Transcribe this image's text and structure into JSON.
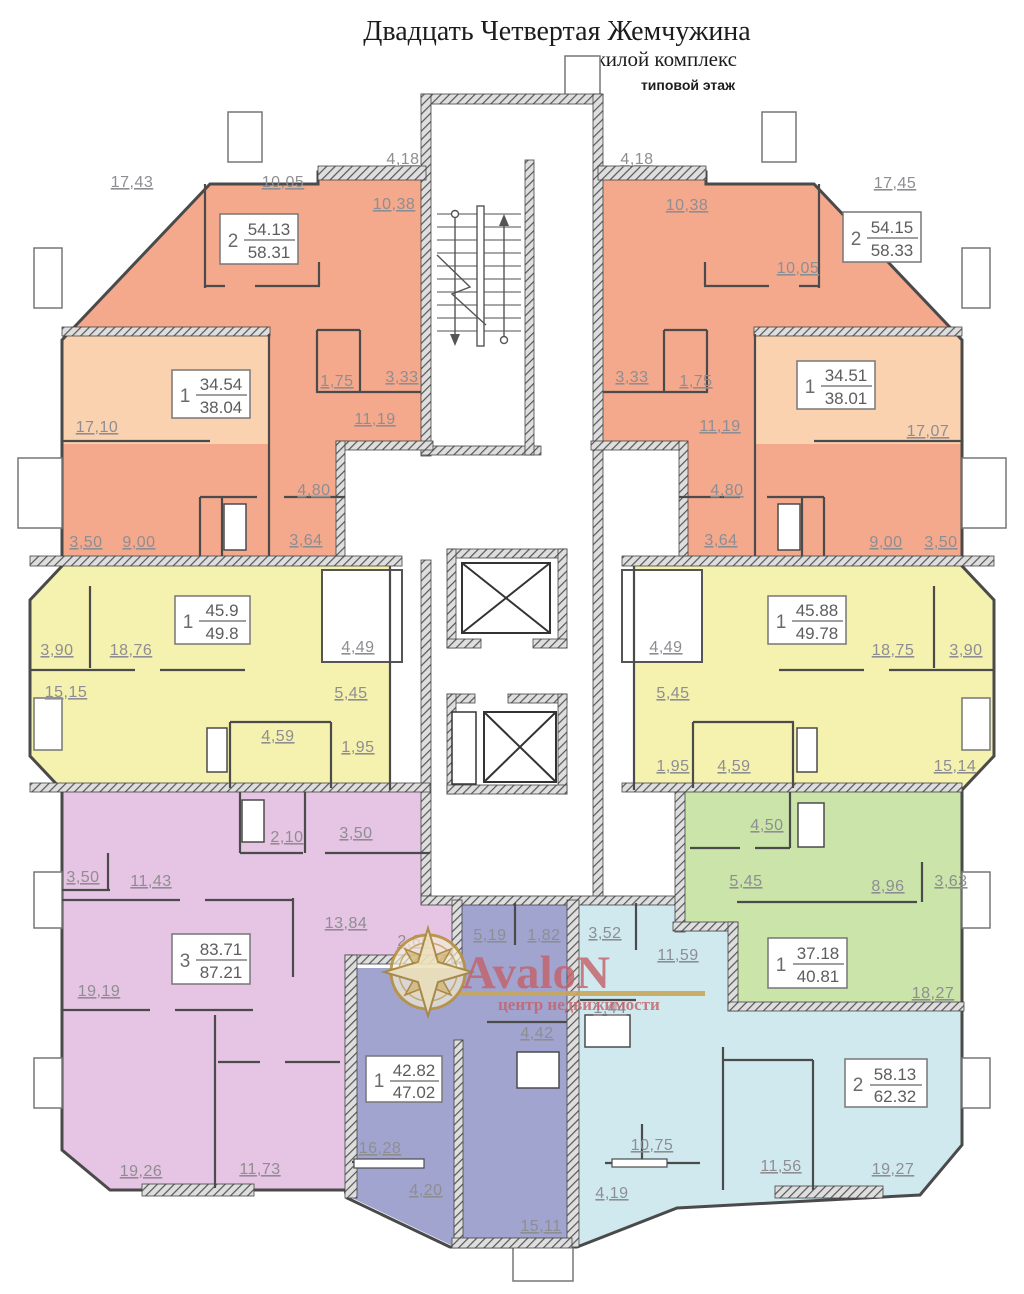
{
  "header": {
    "title": "Двадцать Четвертая  Жемчужина",
    "subtitle": "жилой комплекс",
    "floor_label": "типовой этаж"
  },
  "logo": {
    "brand": "AvaloN",
    "tagline": "центр недвижимости",
    "star_color": "#b8923f",
    "text_color": "#c4636c"
  },
  "palette": {
    "salmon": "#f4a88c",
    "peach": "#fad2b0",
    "yellow": "#f5f1ae",
    "purple": "#e6c4e3",
    "indigo": "#a0a4cf",
    "cyan": "#cfe9ef",
    "green": "#cae4a9",
    "wall": "#4a4a4a",
    "dim_text": "#8e8e92"
  },
  "apartments": {
    "tl2": {
      "type": "2",
      "living": "54.13",
      "total": "58.31",
      "rooms": {
        "r1": "17,43",
        "r2": "10,05",
        "r3": "4,18",
        "r4": "10,38",
        "r5": "1,75",
        "r6": "3,33",
        "r7": "11,19"
      }
    },
    "tr2": {
      "type": "2",
      "living": "54.15",
      "total": "58.33",
      "rooms": {
        "r1": "4,18",
        "r2": "10,38",
        "r3": "17,45",
        "r4": "10,05",
        "r5": "3,33",
        "r6": "1,75",
        "r7": "11,19"
      }
    },
    "tl1": {
      "type": "1",
      "living": "34.54",
      "total": "38.04",
      "rooms": {
        "r1": "17,10",
        "r2": "3,50",
        "r3": "9,00",
        "r4": "4,80",
        "r5": "3,64"
      }
    },
    "tr1": {
      "type": "1",
      "living": "34.51",
      "total": "38.01",
      "rooms": {
        "r1": "17,07",
        "r2": "4,80",
        "r3": "3,64",
        "r4": "9,00",
        "r5": "3,50"
      }
    },
    "yl": {
      "type": "1",
      "living": "45.9",
      "total": "49.8",
      "rooms": {
        "r1": "3,90",
        "r2": "18,76",
        "r3": "4,49",
        "r4": "15,15",
        "r5": "5,45",
        "r6": "4,59",
        "r7": "1,95"
      }
    },
    "yr": {
      "type": "1",
      "living": "45.88",
      "total": "49.78",
      "rooms": {
        "r1": "4,49",
        "r2": "18,75",
        "r3": "3,90",
        "r4": "5,45",
        "r5": "1,95",
        "r6": "4,59",
        "r7": "15,14"
      }
    },
    "p3": {
      "type": "3",
      "living": "83.71",
      "total": "87.21",
      "rooms": {
        "r1": "2,10",
        "r2": "3,50",
        "r3": "3,50",
        "r4": "11,43",
        "r5": "13,84",
        "r6": "2,66",
        "r7": "19,19",
        "r8": "19,26",
        "r9": "11,73"
      }
    },
    "i1": {
      "type": "1",
      "living": "42.82",
      "total": "47.02",
      "rooms": {
        "r1": "5,19",
        "r2": "1,82",
        "r3": "4,42",
        "r4": "16,28",
        "r5": "4,20",
        "r6": "15,11"
      }
    },
    "c2": {
      "type": "2",
      "living": "58.13",
      "total": "62.32",
      "rooms": {
        "r1": "3,52",
        "r2": "11,59",
        "r3": "1,44",
        "r4": "10,75",
        "r5": "4,19",
        "r6": "11,56",
        "r7": "19,27"
      }
    },
    "g1": {
      "type": "1",
      "living": "37.18",
      "total": "40.81",
      "rooms": {
        "r1": "4,50",
        "r2": "5,45",
        "r3": "8,96",
        "r4": "3,63",
        "r5": "18,27"
      }
    }
  }
}
